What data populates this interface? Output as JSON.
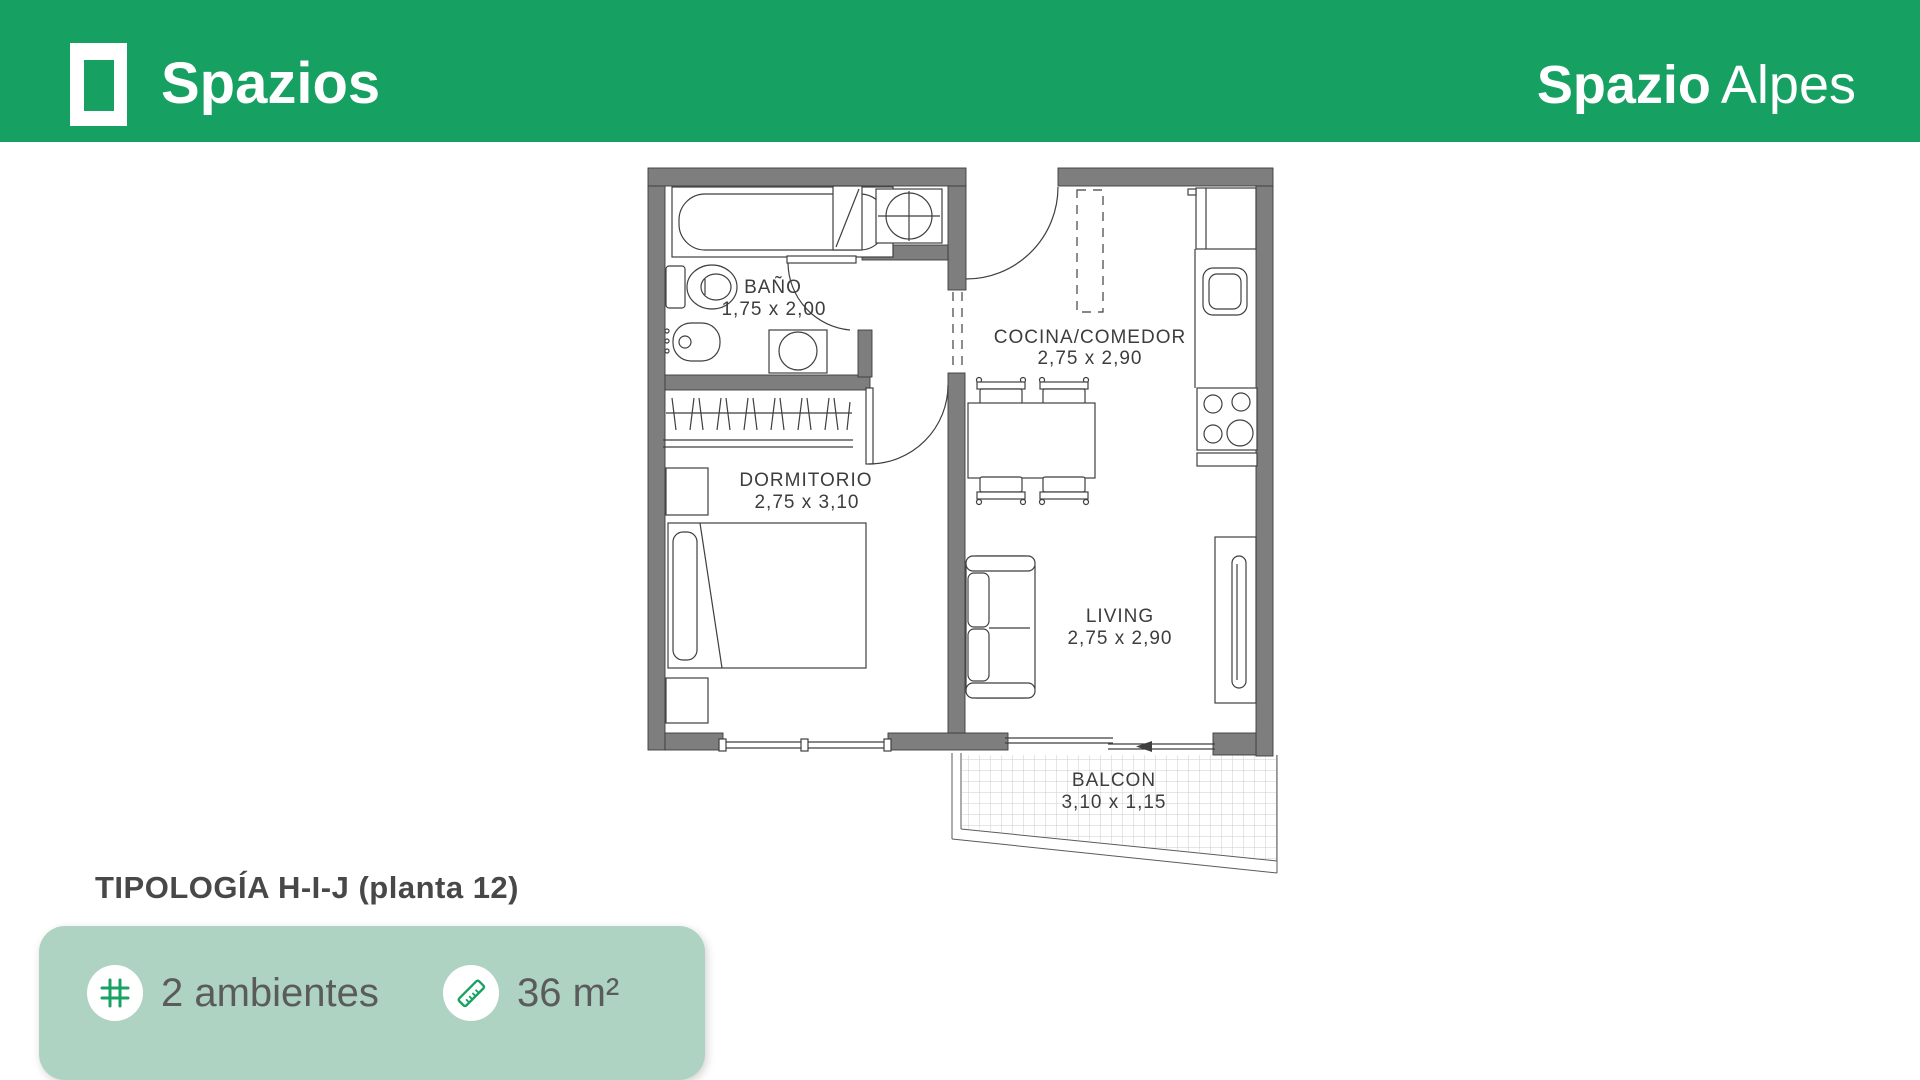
{
  "header": {
    "brand": "Spazios",
    "project": {
      "bold": "Spazio",
      "light": "Alpes"
    },
    "bg_color": "#16a061"
  },
  "floorplan": {
    "rooms": [
      {
        "name": "BAÑO",
        "dimensions": "1,75 x 2,00"
      },
      {
        "name": "COCINA/COMEDOR",
        "dimensions": "2,75 x 2,90"
      },
      {
        "name": "DORMITORIO",
        "dimensions": "2,75 x 3,10"
      },
      {
        "name": "LIVING",
        "dimensions": "2,75 x 2,90"
      },
      {
        "name": "BALCON",
        "dimensions": "3,10 x 1,15"
      }
    ],
    "wall_color": "#7e7e7e",
    "line_color": "#3f3f3f"
  },
  "footer": {
    "title": "TIPOLOGÍA H-I-J (planta 12)",
    "card_color": "#aed3c2",
    "accent_color": "#18a263",
    "badges": [
      {
        "icon": "grid-icon",
        "label": "2 ambientes"
      },
      {
        "icon": "ruler-icon",
        "label": "36 m²"
      }
    ]
  }
}
